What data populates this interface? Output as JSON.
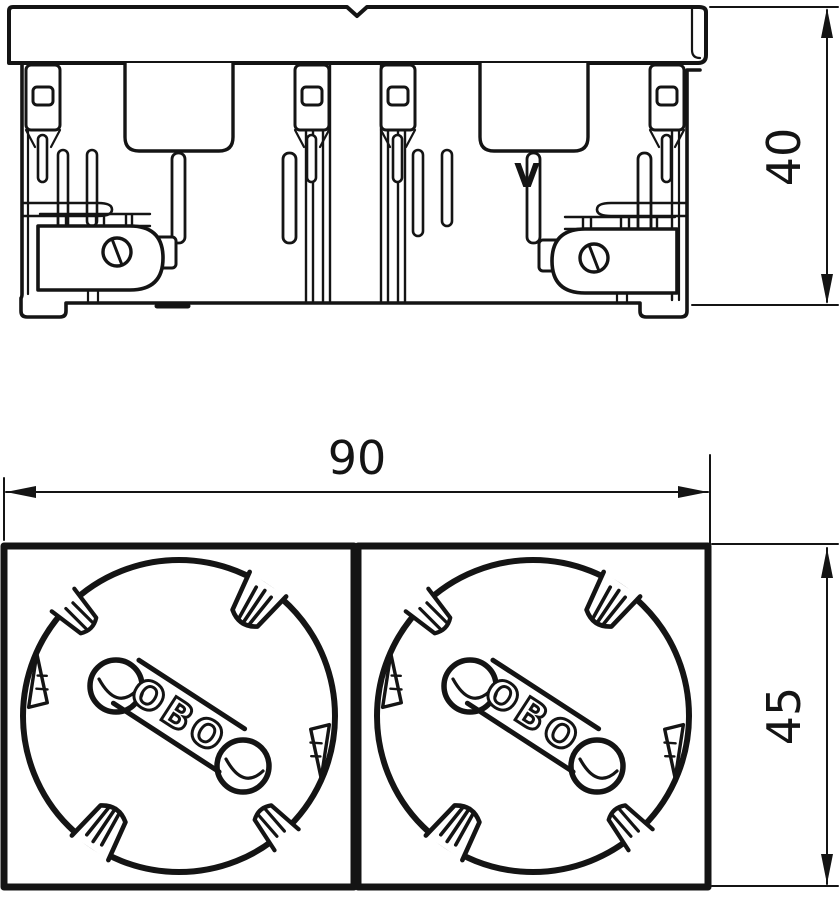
{
  "drawing": {
    "type": "technical-dimension-drawing",
    "colors": {
      "line": "#141414",
      "background": "#ffffff"
    },
    "side_view": {
      "description": "side elevation of double socket insert",
      "marking": "V",
      "height_dimension": {
        "label": "40"
      }
    },
    "front_view": {
      "description": "front face with two round socket wells",
      "sockets": [
        {
          "logo": "OBO"
        },
        {
          "logo": "OBO"
        }
      ],
      "width_dimension": {
        "label": "90"
      },
      "height_dimension": {
        "label": "45"
      }
    }
  }
}
